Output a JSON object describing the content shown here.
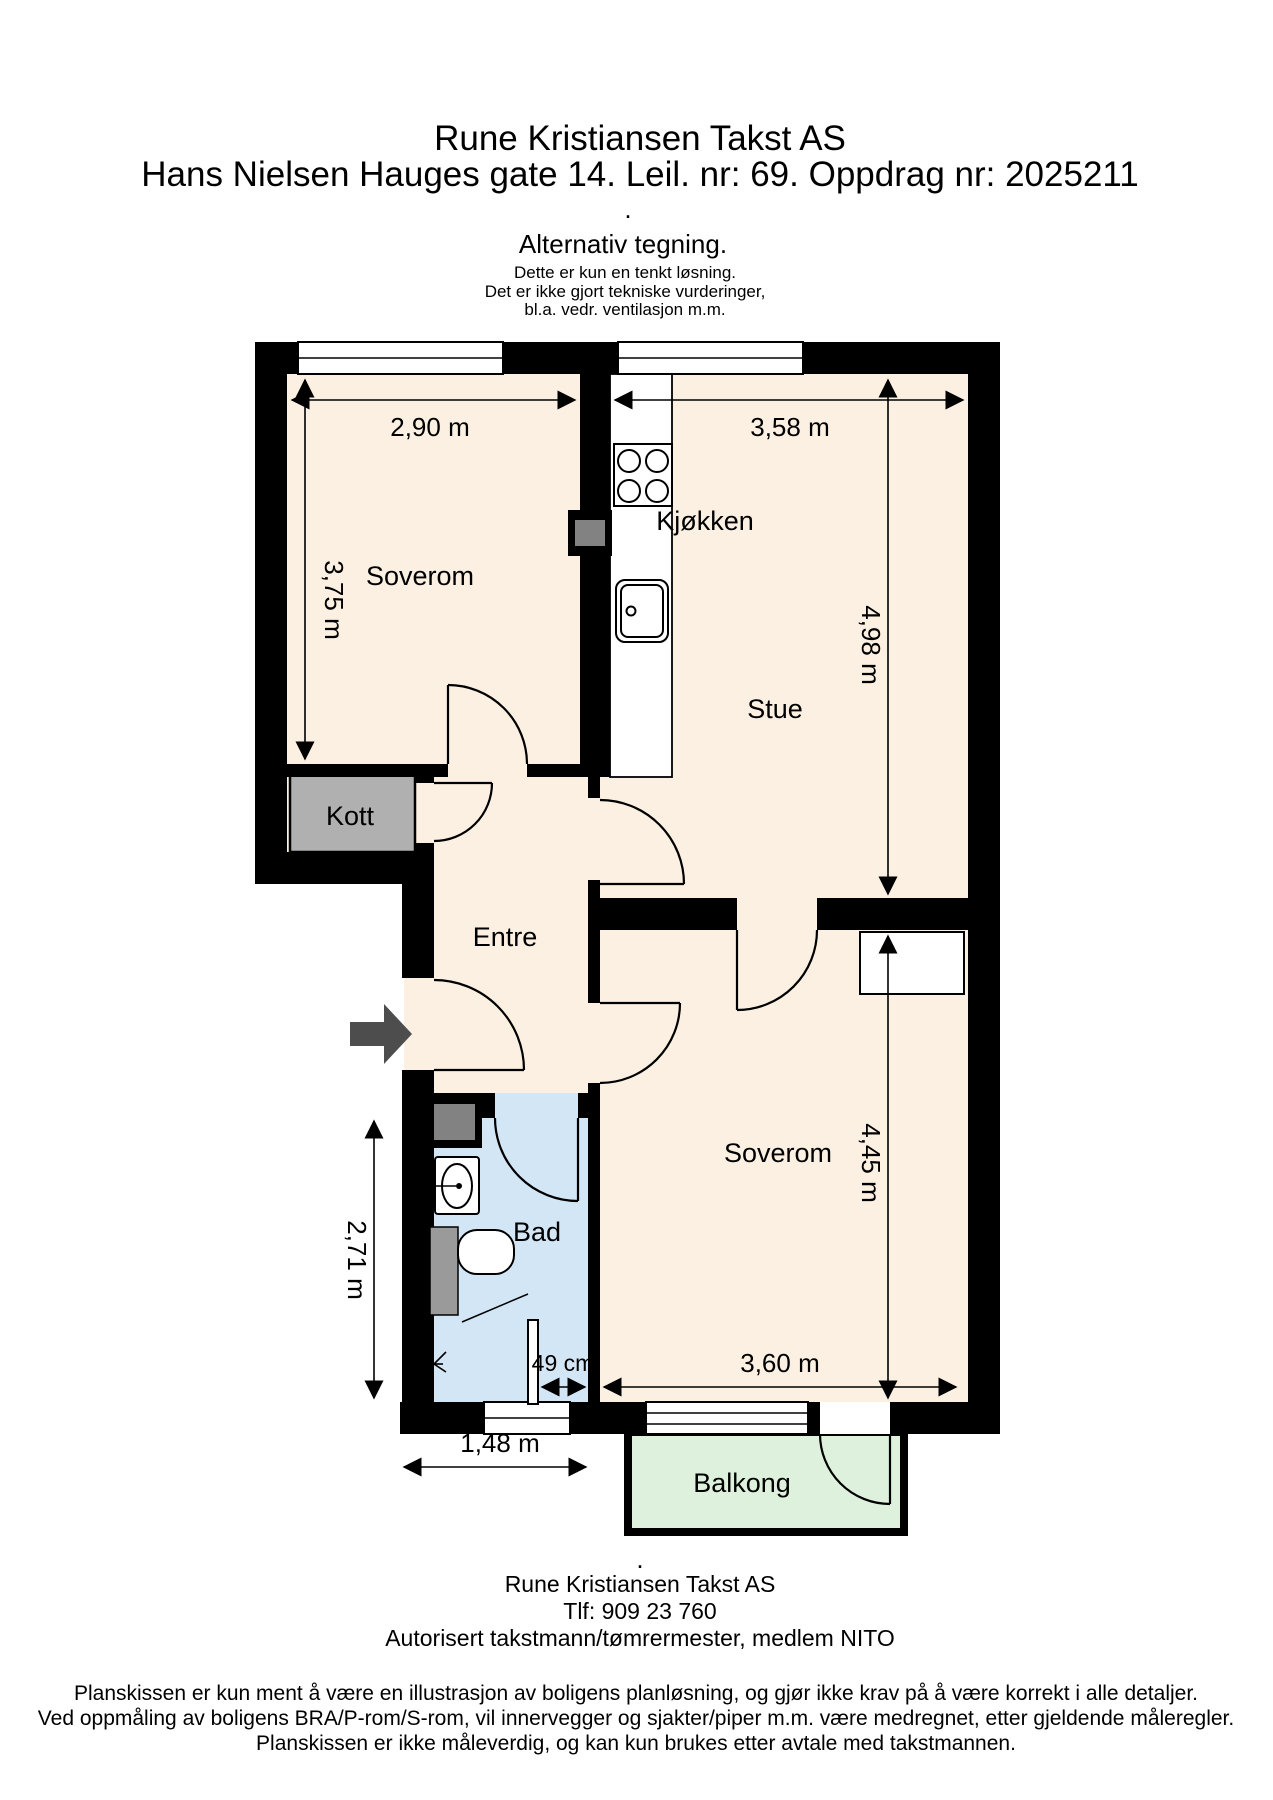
{
  "header": {
    "company": "Rune Kristiansen Takst AS",
    "address": "Hans Nielsen Hauges gate 14. Leil. nr: 69. Oppdrag nr: 2025211",
    "dot": ".",
    "alt_title": "Alternativ tegning.",
    "note1": "Dette er kun en tenkt løsning.",
    "note2": "Det er ikke gjort tekniske vurderinger,",
    "note3": "bl.a. vedr. ventilasjon m.m."
  },
  "rooms": {
    "soverom1": "Soverom",
    "kjokken": "Kjøkken",
    "stue": "Stue",
    "kott": "Kott",
    "entre": "Entre",
    "bad": "Bad",
    "soverom2": "Soverom",
    "balkong": "Balkong"
  },
  "dimensions": {
    "soverom1_width": "2,90 m",
    "kjokken_width": "3,58 m",
    "soverom1_height": "3,75 m",
    "stue_height": "4,98 m",
    "soverom2_height": "4,45 m",
    "soverom2_width": "3,60 m",
    "bad_height": "2,71 m",
    "bad_width": "1,48 m",
    "shower_gap": "49 cm"
  },
  "footer": {
    "dot": ".",
    "company": "Rune Kristiansen Takst AS",
    "phone": "Tlf: 909 23 760",
    "credentials": "Autorisert takstmann/tømrermester, medlem NITO"
  },
  "disclaimer": {
    "line1": "Planskissen er kun ment å være en illustrasjon av boligens planløsning, og gjør ikke krav på å være korrekt i alle detaljer.",
    "line2": "Ved oppmåling av boligens BRA/P-rom/S-rom, vil innervegger og sjakter/piper m.m. være medregnet, etter gjeldende måleregler.",
    "line3": "Planskissen er ikke måleverdig, og kan kun brukes etter avtale med takstmannen."
  },
  "colors": {
    "floor": "#fbf0e1",
    "bathroom": "#d3e6f5",
    "balcony": "#ddf1dc",
    "closet": "#b0b0b0",
    "shaft_gray": "#828282",
    "fixture_gray": "#9a9a9a",
    "wall": "#000000",
    "entry_arrow": "#4d4d4d"
  }
}
